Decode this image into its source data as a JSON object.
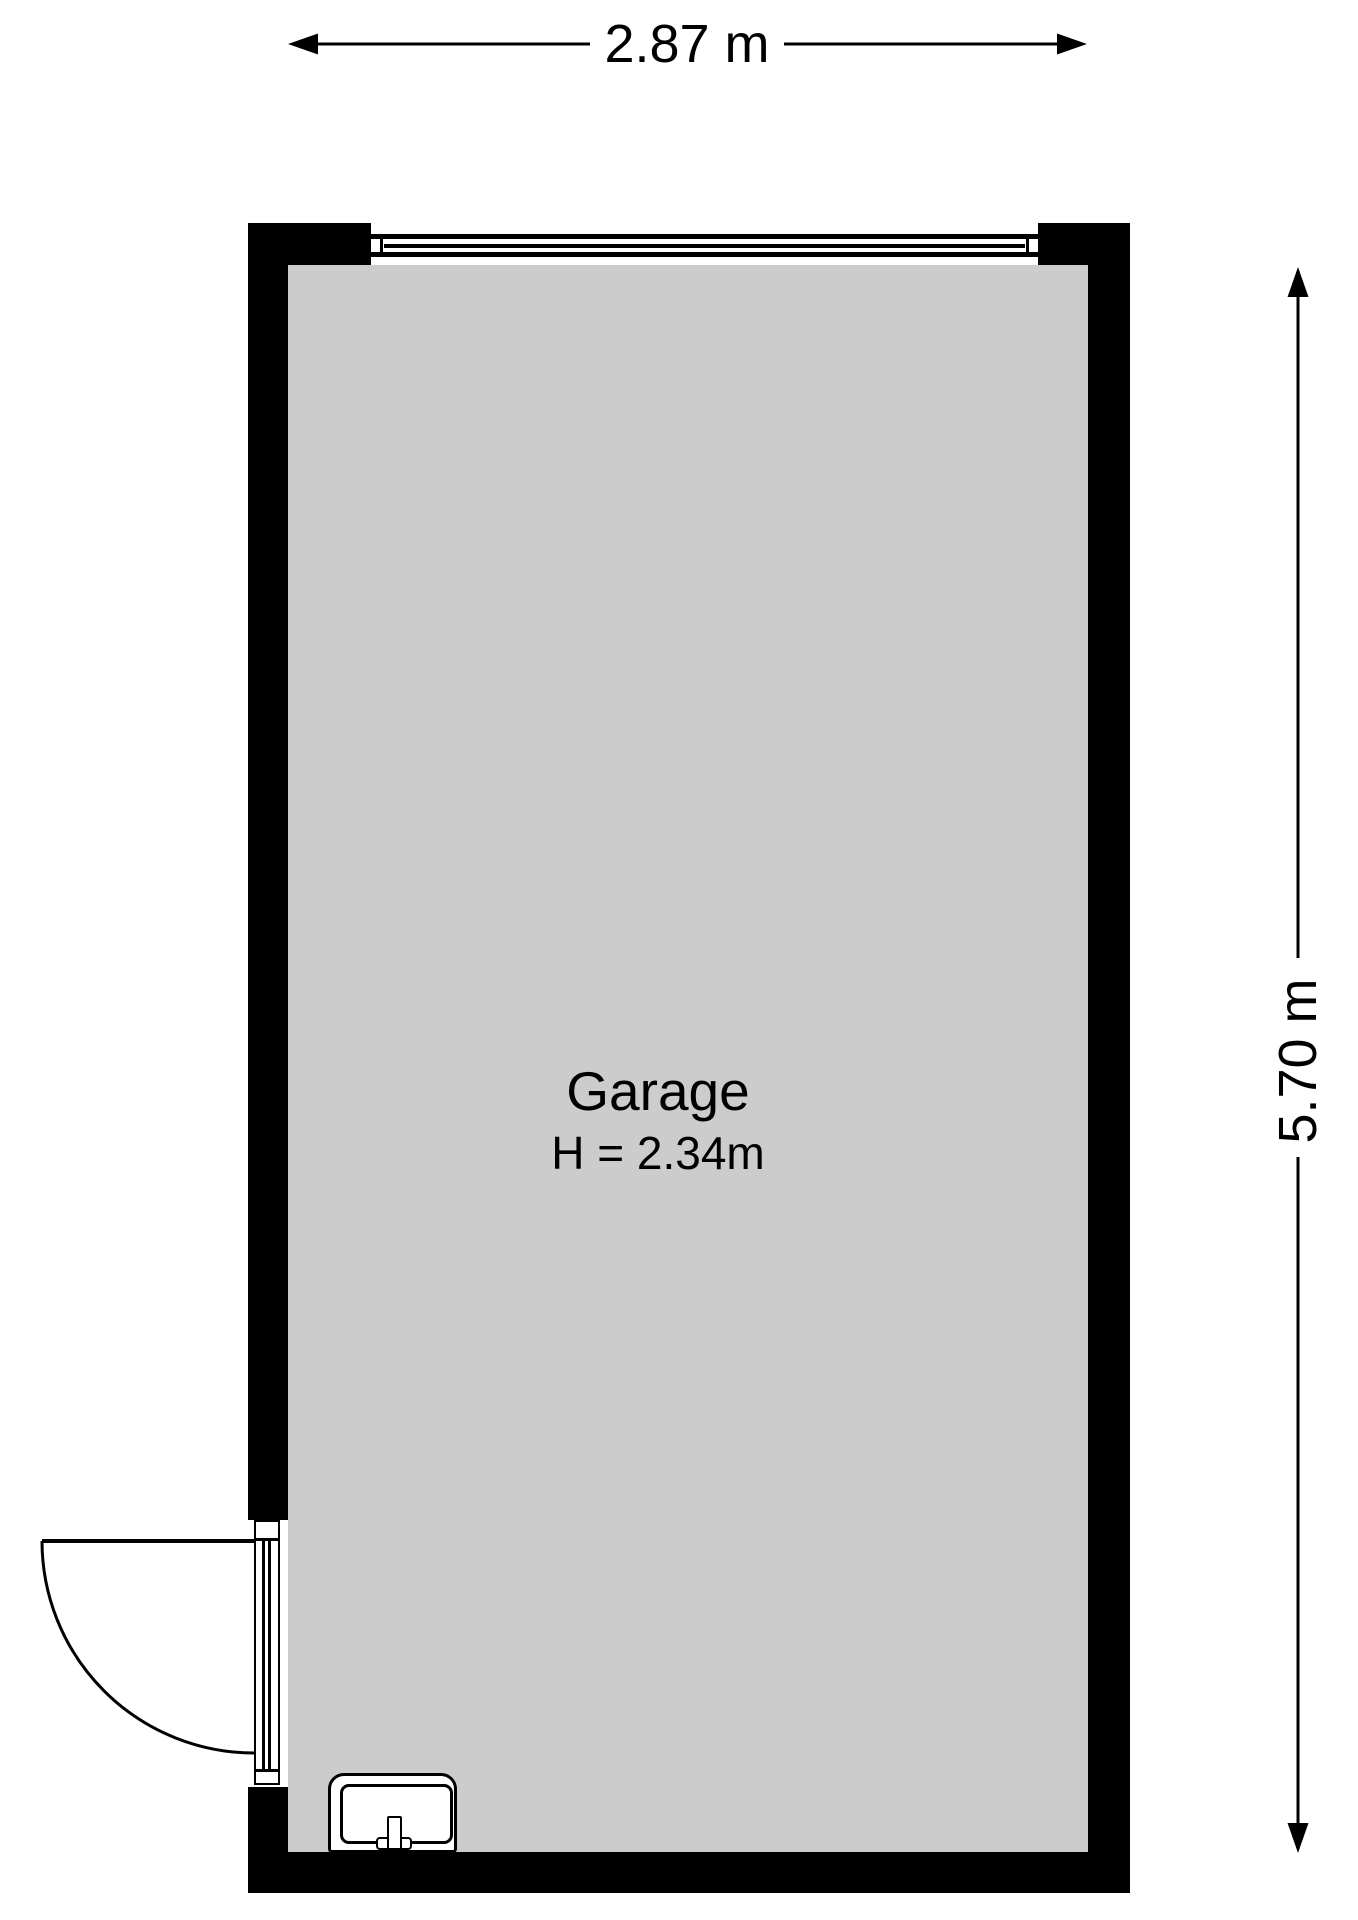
{
  "floorplan": {
    "room": {
      "name": "Garage",
      "ceiling_height_label": "H = 2.34m"
    },
    "dimensions": {
      "width_label": "2.87 m",
      "height_label": "5.70 m"
    },
    "fixtures": {
      "window_icon": "window",
      "door_icon": "hinged-door",
      "sink_icon": "sink"
    },
    "colors": {
      "wall": "#000000",
      "floor": "#cccccc",
      "background": "#ffffff",
      "ink": "#000000"
    }
  }
}
